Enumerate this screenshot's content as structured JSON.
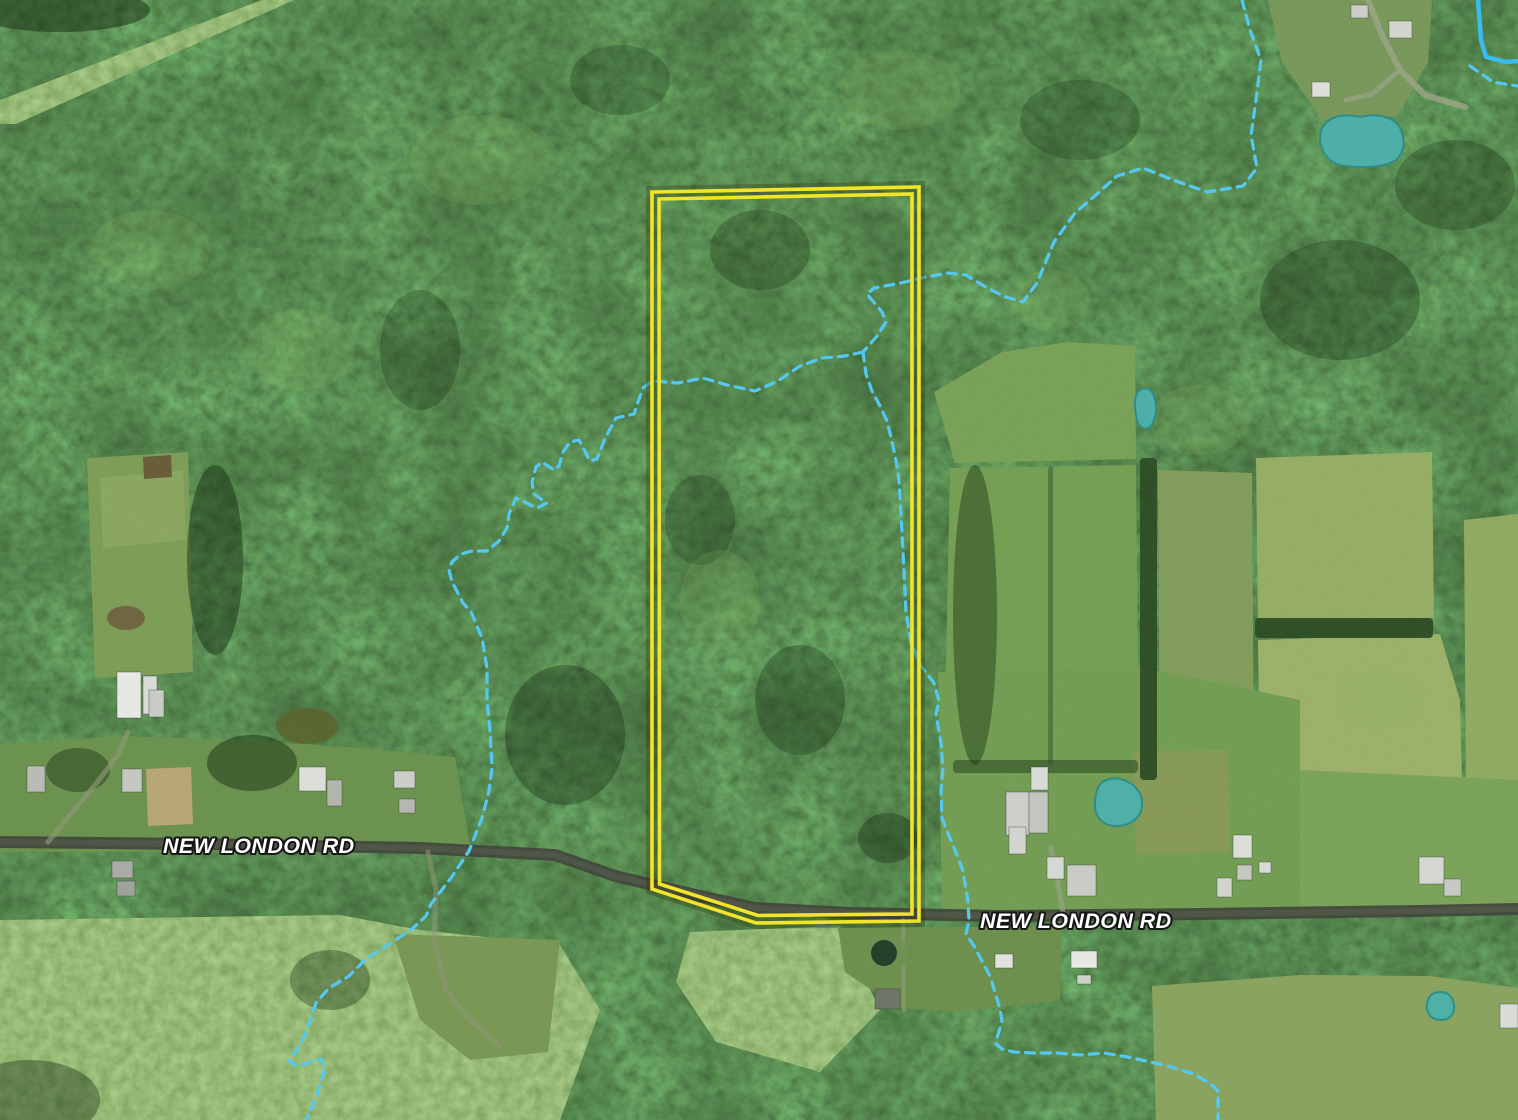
{
  "map": {
    "description": "Aerial satellite view of a wooded rural parcel outlined in yellow along New London Rd, with dashed stream overlays and teal pond overlays",
    "road_labels": [
      {
        "text": "NEW LONDON RD",
        "x": 163,
        "y": 853,
        "size": 21.5
      },
      {
        "text": "NEW LONDON RD",
        "x": 980,
        "y": 928,
        "size": 21.5
      }
    ],
    "colors": {
      "parcel_outline": "#f2e428",
      "parcel_under_glow": "#2c2c08",
      "stream_dashed": "#55c8f2",
      "stream_solid": "#38bdf0",
      "pond_fill": "#4db1ab",
      "pond_edge": "#2f8d87",
      "road": "#42463c",
      "road_center": "#5c6052",
      "label_text": "#ffffff",
      "label_outline": "#161616"
    },
    "parcel": {
      "outer_points": "652,192 919,187 919,921 756,923 652,889",
      "inner_points": "659,199 912,194 912,914 758,915.5 659.5,884"
    },
    "streams": [
      {
        "name": "stream-northeast",
        "points": "1242,0 1250,30 1261,60 1256,100 1251,135 1257,168 1243,186 1207,192 1176,181 1143,168 1117,176 1097,194 1075,213 1054,242 1037,283 1023,302 1003,296 984,286 966,275 948,273 921,278 901,283 874,288 867,294 882,312 886,322 877,336 863,352"
      },
      {
        "name": "stream-west-branch",
        "points": "863,352 845,356 822,358 800,366 778,381 755,391 727,385 703,378 678,383 652,381 643,388 638,402 634,414 616,418 610,429 604,441 597,459 590,461 579,440 570,442 563,452 559,466 554,470 542,462 536,467 532,482 534,494 547,503 537,508 516,498 509,514 507,528 499,541 487,551 472,551 461,554 452,562 449,570 452,582 463,603 471,612 482,638 487,668 487,700 490,731 492,768 489,791 482,818 469,851 451,878 431,904 426,916 412,929 394,941 366,959 349,976 329,988 316,1003 309,1024 301,1044 289,1061 297,1066 321,1059 325,1068 316,1098 306,1120"
      },
      {
        "name": "stream-south-branch",
        "points": "863,352 866,374 872,391 880,406 887,421 893,446 898,471 900,496 902,532 904,572 906,612 911,642 921,666 934,683 939,701 936,714 941,743 943,768 941,791 942,818 947,831 953,845 958,858 963,871 965,884 968,901 969,921 966,934 974,946 991,978 993,986 1000,1009 1002,1021 997,1038 996,1044 1002,1049 1014,1052 1034,1053 1058,1053 1081,1055 1104,1053 1128,1057 1168,1066 1194,1074 1211,1084 1218,1091 1218,1106 1218,1120"
      },
      {
        "name": "stream-corner-dashed",
        "points": "1470,66 1480,73 1493,82 1505,84 1518,86"
      }
    ],
    "water_solid": {
      "name": "stream-corner-solid",
      "points": "1478,0 1481,40 1486,57 1506,62 1518,61",
      "width": 4.5
    },
    "ponds": [
      {
        "name": "pond-topright",
        "path": "M1321,131 C1326,116 1344,113 1360,117 C1380,112 1396,118 1401,130 C1406,143 1403,154 1396,160 C1382,169 1356,168 1340,165 C1327,162 1317,147 1321,131 Z"
      },
      {
        "name": "pond-small-east",
        "path": "M1137,393 C1142,386 1151,387 1154,396 C1158,408 1156,420 1150,427 C1143,431 1137,426 1136,415 C1135,407 1134,399 1137,393 Z"
      },
      {
        "name": "pond-farm-east",
        "path": "M1097,791 C1100,778 1115,776 1126,781 C1138,786 1143,796 1142,806 C1141,818 1131,825 1118,826 C1105,827 1095,818 1095,806 C1095,800 1095,796 1097,791 Z"
      },
      {
        "name": "pond-bottomright",
        "path": "M1428,1000 C1430,992 1441,990 1448,994 C1455,999 1456,1010 1451,1016 C1445,1022 1433,1021 1429,1014 C1426,1009 1426,1005 1428,1000 Z"
      }
    ],
    "dark_ponds": [
      {
        "name": "farm-pond-ring",
        "cx": 884,
        "cy": 953,
        "rx": 24,
        "ry": 21,
        "fill": "#6f9150",
        "opacity": 0.9
      },
      {
        "name": "farm-pond-dark",
        "cx": 884,
        "cy": 953,
        "rx": 13,
        "ry": 13,
        "fill": "#24412c",
        "opacity": 1
      },
      {
        "name": "olive-pond-left",
        "cx": 307,
        "cy": 726,
        "rx": 31,
        "ry": 18,
        "fill": "#5a672f",
        "opacity": 0.95
      },
      {
        "name": "mud-pond-left",
        "cx": 126,
        "cy": 618,
        "rx": 19,
        "ry": 12,
        "fill": "#6e6441",
        "opacity": 0.95
      }
    ],
    "scrubs": [
      {
        "name": "scrub-bottom-left",
        "points": "0,920 340,915 420,930 560,945 600,1010 560,1120 0,1120"
      },
      {
        "name": "scrub-below-parcel",
        "points": "690,932 840,926 880,1010 820,1072 716,1042 676,982"
      },
      {
        "name": "cleared-strip-topleft",
        "points": "262,0 294,0 16,124 0,124 0,100"
      }
    ],
    "fields": [
      {
        "name": "field-left-strip",
        "points": "87,458 188,452 193,672 95,678",
        "fill": "#82a15a"
      },
      {
        "name": "field-left-strip-worn",
        "points": "100,478 183,470 186,540 103,548",
        "fill": "#95ae6a",
        "opacity": 0.55
      },
      {
        "name": "field-brown-patch",
        "points": "143,457 171,455 172,477 144,479",
        "fill": "#6d5b3b"
      },
      {
        "name": "lawn-left-of-road",
        "points": "0,744 120,736 240,740 360,748 455,757 470,845 300,852 0,852",
        "fill": "#6f9551"
      },
      {
        "name": "sand-paddock",
        "points": "146,769 191,767 193,824 148,826",
        "fill": "#c0ab7c"
      },
      {
        "name": "field-right-A",
        "points": "934,392 1002,352 1068,342 1135,346 1136,459 955,463",
        "fill": "#7da65a"
      },
      {
        "name": "field-right-B",
        "points": "950,468 1136,465 1139,770 944,766",
        "fill": "#78a356"
      },
      {
        "name": "field-right-C",
        "points": "1158,470 1252,473 1254,776 1160,779",
        "fill": "#87a15e"
      },
      {
        "name": "field-right-D",
        "points": "1256,458 1432,452 1434,618 1258,621",
        "fill": "#9cb268"
      },
      {
        "name": "field-right-E",
        "points": "1258,640 1440,634 1460,700 1462,782 1260,780",
        "fill": "#a4b66e"
      },
      {
        "name": "field-far-right",
        "points": "1464,520 1518,514 1518,800 1466,790",
        "fill": "#97af66"
      },
      {
        "name": "lawn-right-farm",
        "points": "938,672 1135,666 1300,700 1300,912 942,916",
        "fill": "#76a156"
      },
      {
        "name": "lawn-road-far-right",
        "points": "1300,770 1518,780 1518,912 1300,912",
        "fill": "#7fa75c"
      },
      {
        "name": "scrub-strip-right",
        "points": "1133,752 1228,750 1230,852 1136,854",
        "fill": "#8d9d5a"
      },
      {
        "name": "clearing-top-right",
        "points": "1268,0 1432,0 1428,62 1398,116 1322,120 1282,62",
        "fill": "#7d9b5e"
      },
      {
        "name": "field-bottom-right",
        "points": "1152,986 1300,975 1430,976 1518,988 1518,1120 1156,1120",
        "fill": "#8fa863"
      },
      {
        "name": "clearing-below-parcel",
        "points": "838,928 1062,926 1060,1000 960,1012 898,1008 845,972",
        "fill": "#71924f"
      },
      {
        "name": "meadow-bottom-left-light",
        "points": "393,934 560,940 548,1052 470,1060 420,1020",
        "fill": "#7e9b57"
      }
    ],
    "hedges": [
      {
        "name": "hedgerow-vertical",
        "x": 1140,
        "y": 458,
        "w": 17,
        "h": 322,
        "opacity": 0.95
      },
      {
        "name": "hedgerow-horizontal",
        "x": 1255,
        "y": 618,
        "w": 178,
        "h": 20,
        "opacity": 0.95
      },
      {
        "name": "fence-line",
        "x": 1048,
        "y": 466,
        "w": 5,
        "h": 300,
        "opacity": 0.45
      },
      {
        "name": "hedgerow-south-fields",
        "x": 953,
        "y": 760,
        "w": 185,
        "h": 13,
        "opacity": 0.6
      }
    ],
    "shadows": [
      {
        "cx": 215,
        "cy": 560,
        "rx": 28,
        "ry": 95,
        "o": 0.45
      },
      {
        "cx": 252,
        "cy": 763,
        "rx": 45,
        "ry": 28,
        "o": 0.45
      },
      {
        "cx": 78,
        "cy": 770,
        "rx": 32,
        "ry": 22,
        "o": 0.4
      },
      {
        "cx": 565,
        "cy": 735,
        "rx": 60,
        "ry": 70,
        "o": 0.35
      },
      {
        "cx": 760,
        "cy": 250,
        "rx": 50,
        "ry": 40,
        "o": 0.28
      },
      {
        "cx": 800,
        "cy": 700,
        "rx": 45,
        "ry": 55,
        "o": 0.3
      },
      {
        "cx": 700,
        "cy": 520,
        "rx": 35,
        "ry": 45,
        "o": 0.26
      },
      {
        "cx": 1340,
        "cy": 300,
        "rx": 80,
        "ry": 60,
        "o": 0.3
      },
      {
        "cx": 1455,
        "cy": 185,
        "rx": 60,
        "ry": 45,
        "o": 0.28
      },
      {
        "cx": 975,
        "cy": 615,
        "rx": 22,
        "ry": 150,
        "o": 0.4
      },
      {
        "cx": 420,
        "cy": 350,
        "rx": 40,
        "ry": 60,
        "o": 0.26
      },
      {
        "cx": 620,
        "cy": 80,
        "rx": 50,
        "ry": 35,
        "o": 0.26
      },
      {
        "cx": 888,
        "cy": 838,
        "rx": 30,
        "ry": 25,
        "o": 0.35
      },
      {
        "cx": 1080,
        "cy": 120,
        "rx": 60,
        "ry": 40,
        "o": 0.26
      },
      {
        "cx": 330,
        "cy": 980,
        "rx": 40,
        "ry": 30,
        "o": 0.35
      },
      {
        "cx": 60,
        "cy": 10,
        "rx": 90,
        "ry": 22,
        "o": 0.5
      },
      {
        "cx": 30,
        "cy": 1100,
        "rx": 70,
        "ry": 40,
        "o": 0.4
      }
    ],
    "highlights": [
      {
        "cx": 480,
        "cy": 160,
        "rx": 70,
        "ry": 45
      },
      {
        "cx": 900,
        "cy": 90,
        "rx": 60,
        "ry": 40
      },
      {
        "cx": 1200,
        "cy": 420,
        "rx": 50,
        "ry": 35
      },
      {
        "cx": 300,
        "cy": 350,
        "rx": 55,
        "ry": 40
      },
      {
        "cx": 720,
        "cy": 600,
        "rx": 40,
        "ry": 50
      },
      {
        "cx": 1380,
        "cy": 700,
        "rx": 45,
        "ry": 30
      },
      {
        "cx": 150,
        "cy": 250,
        "rx": 60,
        "ry": 40
      },
      {
        "cx": 1050,
        "cy": 300,
        "rx": 40,
        "ry": 30
      }
    ],
    "roads": [
      {
        "name": "new-london-rd-pavement",
        "points": "0,842 200,844 420,848 555,855 615,876 700,896 755,908 850,913 1000,916 1200,914 1420,911 1518,909",
        "width": 12,
        "color": "#42463c",
        "opacity": 0.92,
        "center": true
      }
    ],
    "trails": [
      {
        "name": "driveway-top-right",
        "points": "1368,0 1382,35 1400,70 1425,95 1465,107",
        "width": 6,
        "color": "#9aa486",
        "opacity": 0.85
      },
      {
        "name": "driveway-top-right-spur",
        "points": "1400,70 1372,94 1346,100",
        "width": 5,
        "color": "#9aa486",
        "opacity": 0.7
      },
      {
        "name": "farm-lane-left",
        "points": "48,842 70,815 95,785 118,755 128,732",
        "width": 5,
        "color": "#8e9878",
        "opacity": 0.65
      },
      {
        "name": "trail-bottom-left",
        "points": "428,852 436,890 434,940 446,990 470,1020 500,1046",
        "width": 5,
        "color": "#8e9878",
        "opacity": 0.55
      },
      {
        "name": "trail-below-parcel",
        "points": "903,920 904,1010",
        "width": 4,
        "color": "#8a9a72",
        "opacity": 0.7
      },
      {
        "name": "farm-drive-right",
        "points": "1063,913 1057,878 1051,848",
        "width": 5,
        "color": "#98a286",
        "opacity": 0.7
      }
    ],
    "buildings": [
      {
        "x": 117,
        "y": 672,
        "w": 24,
        "h": 46,
        "fill": "#e6e8e4"
      },
      {
        "x": 143,
        "y": 676,
        "w": 14,
        "h": 38,
        "fill": "#d9dbd6"
      },
      {
        "x": 149,
        "y": 690,
        "w": 15,
        "h": 27,
        "fill": "#c9ccc6"
      },
      {
        "x": 27,
        "y": 766,
        "w": 18,
        "h": 26,
        "fill": "#b8bcb4"
      },
      {
        "x": 122,
        "y": 769,
        "w": 20,
        "h": 23,
        "fill": "#c4c7c0"
      },
      {
        "x": 299,
        "y": 767,
        "w": 27,
        "h": 24,
        "fill": "#dcddd8"
      },
      {
        "x": 327,
        "y": 780,
        "w": 15,
        "h": 26,
        "fill": "#b2b6ae"
      },
      {
        "x": 394,
        "y": 771,
        "w": 21,
        "h": 17,
        "fill": "#cbcec7"
      },
      {
        "x": 399,
        "y": 799,
        "w": 16,
        "h": 14,
        "fill": "#b4b8b0"
      },
      {
        "x": 112,
        "y": 861,
        "w": 21,
        "h": 17,
        "fill": "#a9aca4"
      },
      {
        "x": 117,
        "y": 881,
        "w": 18,
        "h": 15,
        "fill": "#9fa29a"
      },
      {
        "x": 995,
        "y": 954,
        "w": 18,
        "h": 14,
        "fill": "#dfe1dc"
      },
      {
        "x": 1071,
        "y": 951,
        "w": 26,
        "h": 17,
        "fill": "#e7e8e4"
      },
      {
        "x": 1077,
        "y": 975,
        "w": 14,
        "h": 9,
        "fill": "#cfd2cb"
      },
      {
        "x": 875,
        "y": 989,
        "w": 25,
        "h": 20,
        "fill": "#6f756b"
      },
      {
        "x": 1006,
        "y": 792,
        "w": 23,
        "h": 43,
        "fill": "#cdd0ca"
      },
      {
        "x": 1031,
        "y": 767,
        "w": 17,
        "h": 23,
        "fill": "#d9dbd6"
      },
      {
        "x": 1029,
        "y": 792,
        "w": 19,
        "h": 41,
        "fill": "#c2c6bf"
      },
      {
        "x": 1009,
        "y": 827,
        "w": 17,
        "h": 27,
        "fill": "#d2d5cf"
      },
      {
        "x": 1047,
        "y": 857,
        "w": 17,
        "h": 22,
        "fill": "#d6d8d3"
      },
      {
        "x": 1067,
        "y": 865,
        "w": 29,
        "h": 31,
        "fill": "#c9ccc5"
      },
      {
        "x": 1217,
        "y": 878,
        "w": 15,
        "h": 19,
        "fill": "#d2d5cf"
      },
      {
        "x": 1233,
        "y": 835,
        "w": 19,
        "h": 23,
        "fill": "#dbddd7"
      },
      {
        "x": 1237,
        "y": 865,
        "w": 15,
        "h": 15,
        "fill": "#c5c8c1"
      },
      {
        "x": 1259,
        "y": 862,
        "w": 12,
        "h": 11,
        "fill": "#d7d9d4"
      },
      {
        "x": 1419,
        "y": 857,
        "w": 25,
        "h": 27,
        "fill": "#d4d6d1"
      },
      {
        "x": 1444,
        "y": 879,
        "w": 17,
        "h": 17,
        "fill": "#c7cac3"
      },
      {
        "x": 1500,
        "y": 1004,
        "w": 18,
        "h": 24,
        "fill": "#dadcd7"
      },
      {
        "x": 1312,
        "y": 82,
        "w": 18,
        "h": 15,
        "fill": "#dcded9"
      },
      {
        "x": 1389,
        "y": 21,
        "w": 23,
        "h": 17,
        "fill": "#d2d5ce"
      },
      {
        "x": 1351,
        "y": 5,
        "w": 17,
        "h": 13,
        "fill": "#cbcec8"
      }
    ]
  }
}
